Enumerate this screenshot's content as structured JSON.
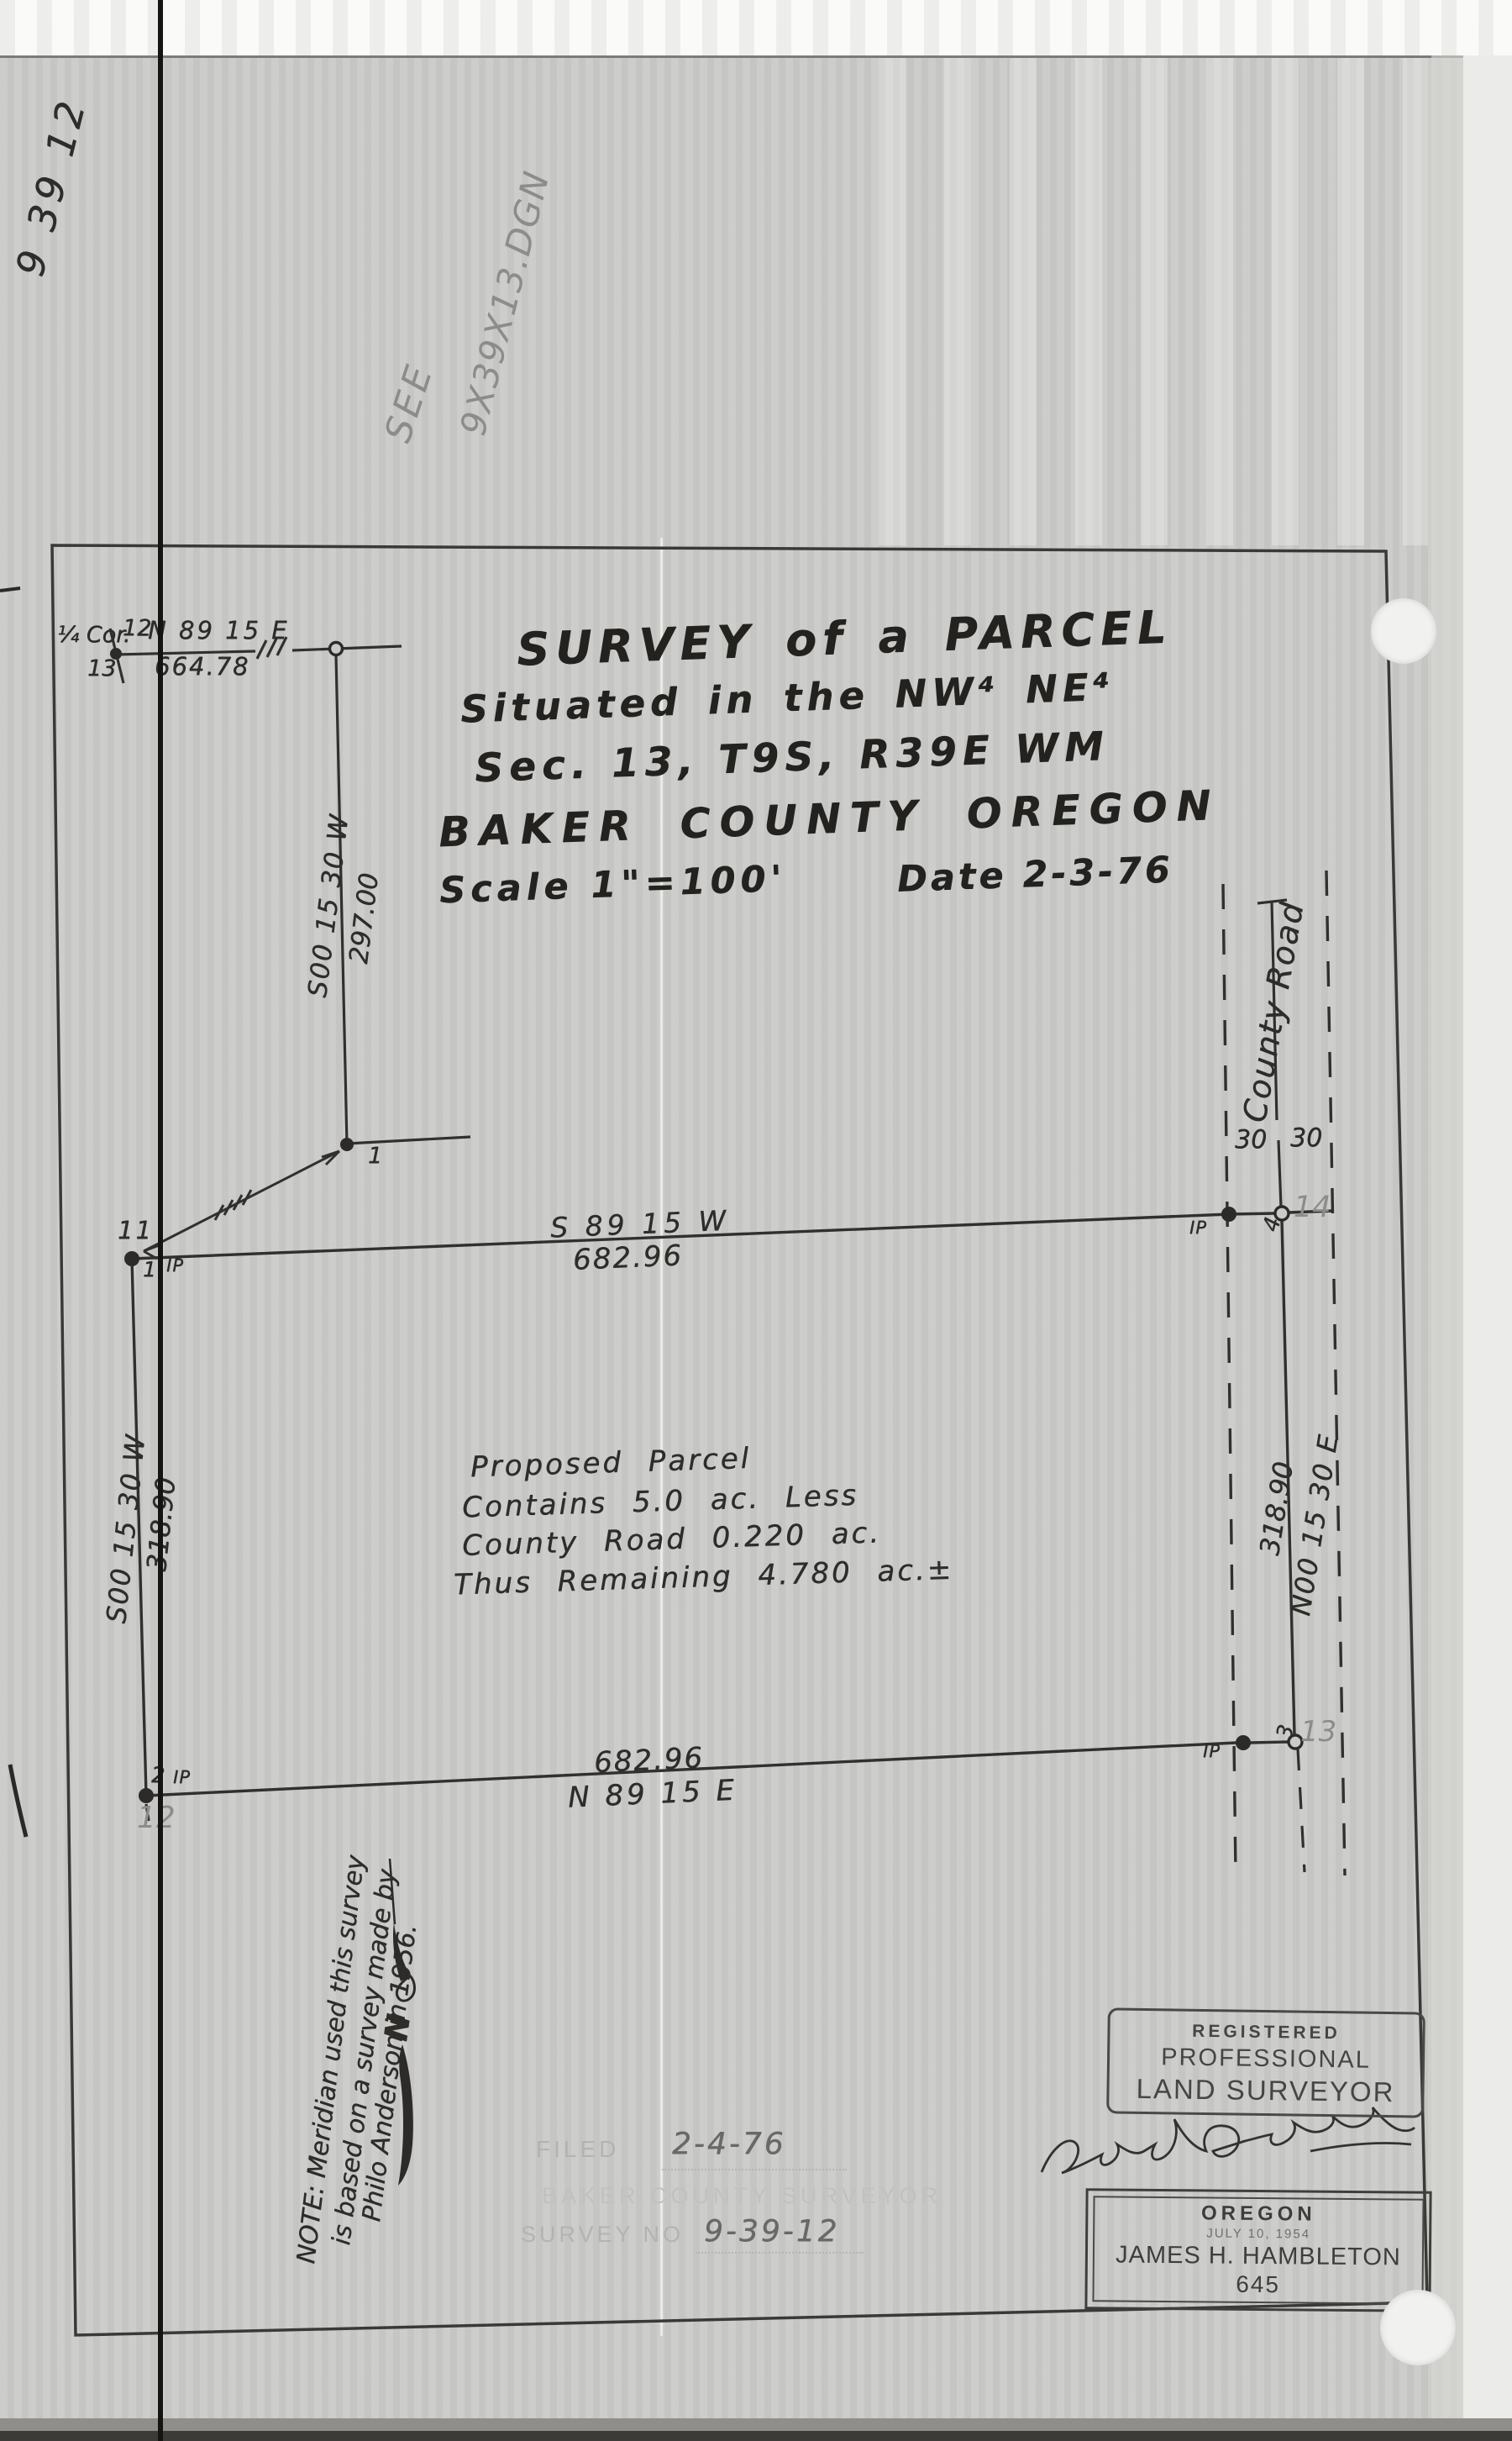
{
  "doc": {
    "type_note": "9 39 12",
    "see_note": [
      "SEE",
      "9X39X13.DGN"
    ]
  },
  "title_block": {
    "line1": "SURVEY of a PARCEL",
    "line2": "Situated in the NW⁴ NE⁴",
    "line3": "Sec. 13, T9S, R39E WM",
    "line4": "BAKER COUNTY OREGON",
    "scale": "Scale 1\"=100'",
    "date": "Date 2-3-76"
  },
  "section_corner": {
    "label": "¼ Cor.",
    "section_above": "12",
    "section_below": "13",
    "bearing": "N 89 15 E",
    "distance": "664.78"
  },
  "spur_line": {
    "bearing": "S00 15 30 W",
    "distance": "297.00"
  },
  "north_line": {
    "bearing": "S 89 15 W",
    "distance": "682.96"
  },
  "south_line": {
    "bearing": "N 89 15 E",
    "distance": "682.96"
  },
  "west_line": {
    "bearing": "S00 15 30 W",
    "distance": "318.90"
  },
  "east_line": {
    "bearing": "N00 15 30 E",
    "distance": "318.90"
  },
  "road": {
    "name": "County Road",
    "half_width_left": "30",
    "half_width_right": "30"
  },
  "points": {
    "p1": "1",
    "nw_pencil": "11",
    "nw_num": "1",
    "nw_ip": "IP",
    "ne_ip": "IP",
    "ne_circle": "4",
    "ne_pencil": "14",
    "sw_num": "2",
    "sw_ip": "IP",
    "sw_pencil": "12",
    "se_ip": "IP",
    "se_circle": "3",
    "se_pencil": "13"
  },
  "parcel_note": [
    "Proposed Parcel",
    "Contains 5.0 ac. Less",
    "County Road 0.220 ac.",
    "Thus Remaining 4.780 ac.±"
  ],
  "meridian_note": [
    "NOTE: Meridian used this survey",
    "is based on a survey made by",
    "Philo Anderson in 1956."
  ],
  "north_arrow_letter": "N",
  "registered_stamp": [
    "REGISTERED",
    "PROFESSIONAL",
    "LAND SURVEYOR"
  ],
  "signature_name": "James H Hambleton",
  "license_stamp": {
    "state": "OREGON",
    "date": "JULY 10, 1954",
    "name": "JAMES H. HAMBLETON",
    "number": "645"
  },
  "filing_stamp": {
    "filed_label": "FILED",
    "filed_date": "2-4-76",
    "office_line": "BAKER COUNTY SURVEYOR",
    "survey_no_label": "SURVEY NO",
    "survey_no": "9-39-12"
  }
}
